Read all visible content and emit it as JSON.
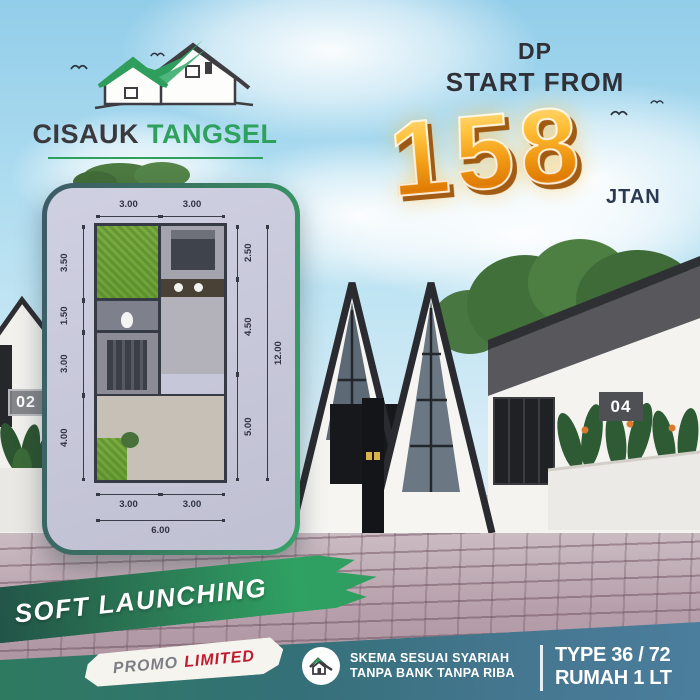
{
  "brand": {
    "primary": "CISAUK",
    "secondary": "TANGSEL"
  },
  "offer": {
    "dp": "DP",
    "start_from": "START FROM",
    "amount": "158",
    "unit": "JTAN"
  },
  "units": {
    "left": "02",
    "right": "04"
  },
  "floorplan": {
    "top": [
      "3.00",
      "3.00"
    ],
    "left": [
      "3.50",
      "1.50",
      "3.00",
      "4.00"
    ],
    "right": [
      "2.50",
      "4.50",
      "5.00"
    ],
    "right_total": "12.00",
    "bottom": [
      "3.00",
      "3.00"
    ],
    "bottom_total": "6.00"
  },
  "footer": {
    "ribbon": "SOFT LAUNCHING",
    "promo": "PROMO",
    "promo_highlight": "LIMITED",
    "syariah_line1": "SKEMA SESUAI SYARIAH",
    "syariah_line2": "TANPA BANK TANPA RIBA",
    "type_line1": "TYPE 36 / 72",
    "type_line2": "RUMAH 1 LT"
  },
  "colors": {
    "brand_green": "#2fa05e",
    "gold": "#f29c16",
    "gold_shadow": "#994d00",
    "band_green": "#2e7a5f",
    "band_blue": "#4b7e9d",
    "ribbon_dark": "#214f46",
    "promo_red": "#c01a2e",
    "text_dark": "#2f3038",
    "navy": "#2b3a50",
    "plan_bg": "#c6c7d9",
    "sky": "#a9daef"
  }
}
